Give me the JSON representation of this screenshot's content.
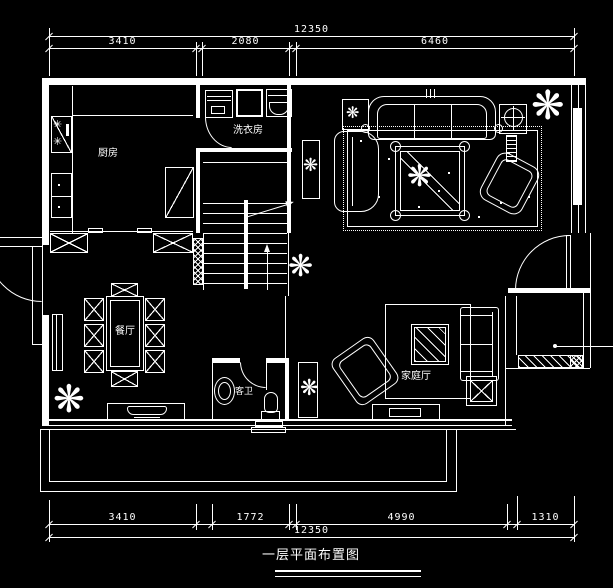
{
  "drawing": {
    "title": "一层平面布置图",
    "background_color": "#000000",
    "line_color": "#ffffff"
  },
  "rooms": {
    "kitchen": {
      "label": "厨房"
    },
    "laundry": {
      "label": "洗衣房"
    },
    "dining": {
      "label": "餐厅"
    },
    "bathroom": {
      "label": "客卫"
    },
    "family": {
      "label": "家庭厅"
    }
  },
  "dimensions": {
    "top": {
      "overall": "12350",
      "segments": [
        "3410",
        "2080",
        "6460"
      ]
    },
    "bottom": {
      "overall": "12350",
      "segments": [
        "3410",
        "1772",
        "4990",
        "1310"
      ]
    }
  },
  "icons": {
    "plant_glyph": "❋",
    "burner_glyph": "✳"
  }
}
